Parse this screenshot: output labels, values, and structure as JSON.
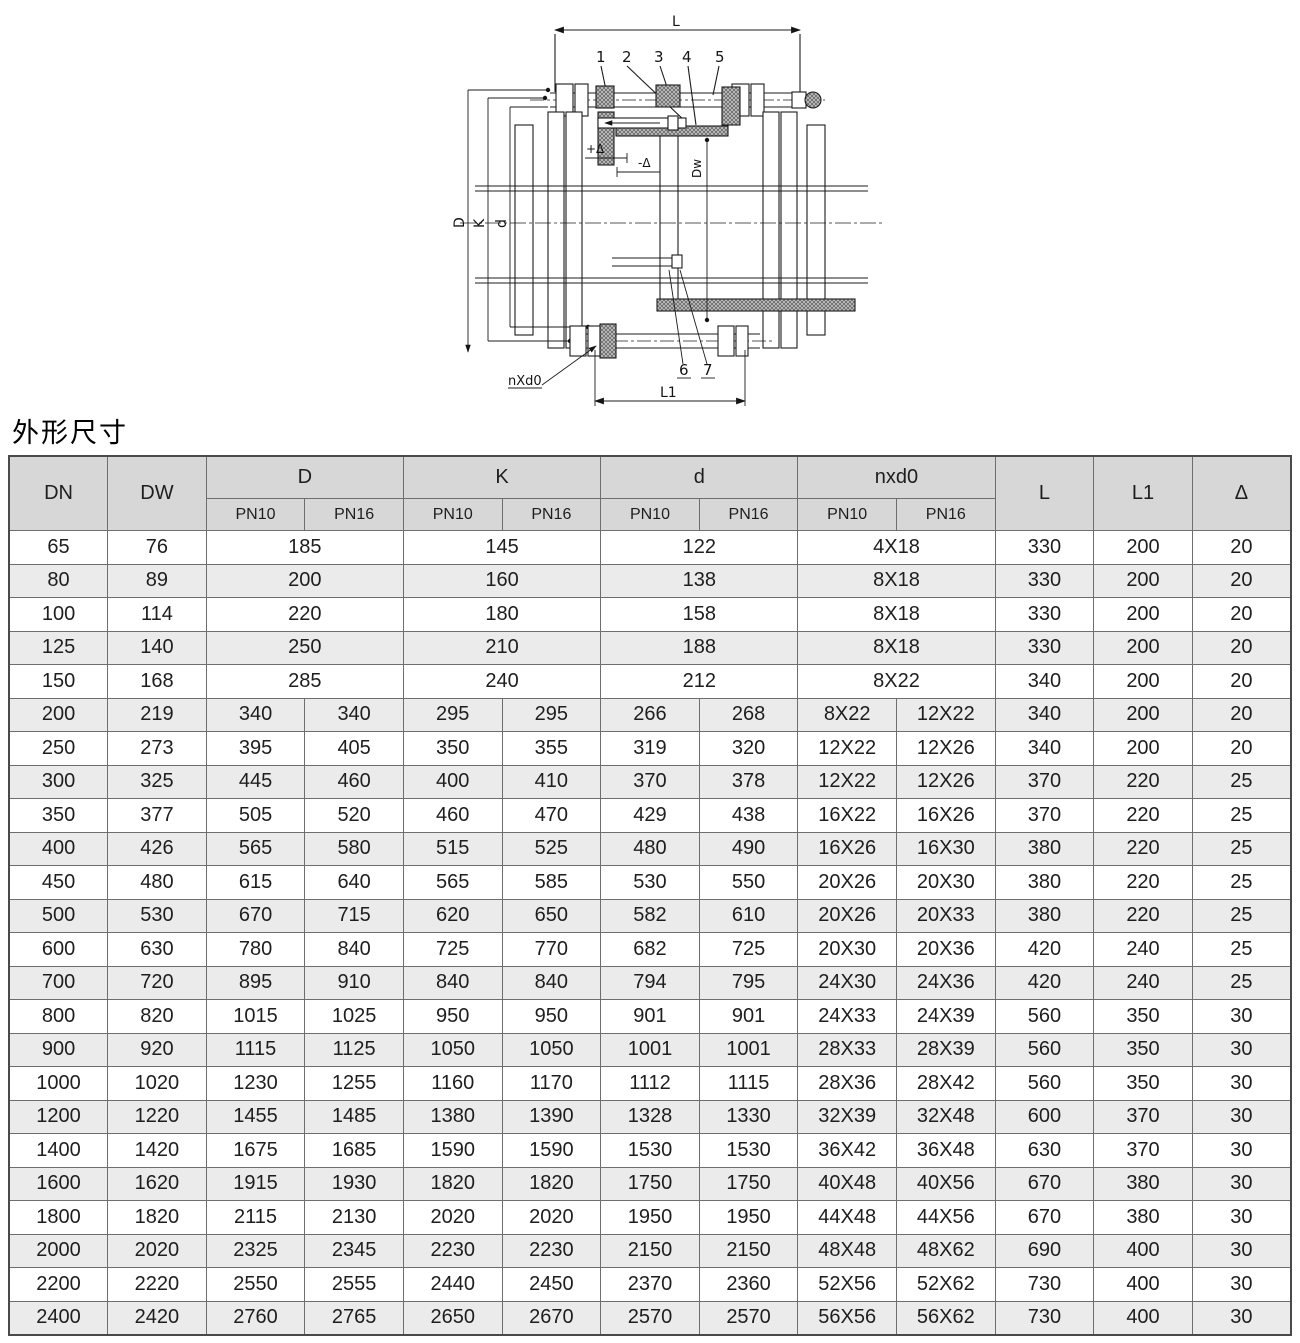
{
  "page": {
    "title": "外形尺寸"
  },
  "colors": {
    "header_bg": "#d7d7d7",
    "row_bg": "#ffffff",
    "row_alt_bg": "#ebebeb",
    "border": "#6e6e6e",
    "border_outer": "#4a4a4a",
    "text": "#1e1e1e",
    "line": "#1c1c1c"
  },
  "drawing": {
    "dim_labels": {
      "l": "L",
      "l1": "L1",
      "d_outer": "D",
      "k": "K",
      "d_inner": "d",
      "dw": "Dw",
      "nxd0": "nXd0",
      "delta_plus": "+Δ",
      "delta_minus": "-Δ"
    },
    "part_labels": [
      "1",
      "2",
      "3",
      "4",
      "5",
      "6",
      "7"
    ]
  },
  "table": {
    "headers": {
      "dn": "DN",
      "dw": "DW",
      "d_group": "D",
      "k_group": "K",
      "d_small_group": "d",
      "nxd0_group": "nxd0",
      "l": "L",
      "l1": "L1",
      "delta": "Δ",
      "pn10": "PN10",
      "pn16": "PN16"
    },
    "rows": [
      {
        "merged": true,
        "cells": [
          "65",
          "76",
          "185",
          "145",
          "122",
          "4X18",
          "330",
          "200",
          "20"
        ]
      },
      {
        "merged": true,
        "cells": [
          "80",
          "89",
          "200",
          "160",
          "138",
          "8X18",
          "330",
          "200",
          "20"
        ]
      },
      {
        "merged": true,
        "cells": [
          "100",
          "114",
          "220",
          "180",
          "158",
          "8X18",
          "330",
          "200",
          "20"
        ]
      },
      {
        "merged": true,
        "cells": [
          "125",
          "140",
          "250",
          "210",
          "188",
          "8X18",
          "330",
          "200",
          "20"
        ]
      },
      {
        "merged": true,
        "cells": [
          "150",
          "168",
          "285",
          "240",
          "212",
          "8X22",
          "340",
          "200",
          "20"
        ]
      },
      {
        "merged": false,
        "cells": [
          "200",
          "219",
          "340",
          "340",
          "295",
          "295",
          "266",
          "268",
          "8X22",
          "12X22",
          "340",
          "200",
          "20"
        ]
      },
      {
        "merged": false,
        "cells": [
          "250",
          "273",
          "395",
          "405",
          "350",
          "355",
          "319",
          "320",
          "12X22",
          "12X26",
          "340",
          "200",
          "20"
        ]
      },
      {
        "merged": false,
        "cells": [
          "300",
          "325",
          "445",
          "460",
          "400",
          "410",
          "370",
          "378",
          "12X22",
          "12X26",
          "370",
          "220",
          "25"
        ]
      },
      {
        "merged": false,
        "cells": [
          "350",
          "377",
          "505",
          "520",
          "460",
          "470",
          "429",
          "438",
          "16X22",
          "16X26",
          "370",
          "220",
          "25"
        ]
      },
      {
        "merged": false,
        "cells": [
          "400",
          "426",
          "565",
          "580",
          "515",
          "525",
          "480",
          "490",
          "16X26",
          "16X30",
          "380",
          "220",
          "25"
        ]
      },
      {
        "merged": false,
        "cells": [
          "450",
          "480",
          "615",
          "640",
          "565",
          "585",
          "530",
          "550",
          "20X26",
          "20X30",
          "380",
          "220",
          "25"
        ]
      },
      {
        "merged": false,
        "cells": [
          "500",
          "530",
          "670",
          "715",
          "620",
          "650",
          "582",
          "610",
          "20X26",
          "20X33",
          "380",
          "220",
          "25"
        ]
      },
      {
        "merged": false,
        "cells": [
          "600",
          "630",
          "780",
          "840",
          "725",
          "770",
          "682",
          "725",
          "20X30",
          "20X36",
          "420",
          "240",
          "25"
        ]
      },
      {
        "merged": false,
        "cells": [
          "700",
          "720",
          "895",
          "910",
          "840",
          "840",
          "794",
          "795",
          "24X30",
          "24X36",
          "420",
          "240",
          "25"
        ]
      },
      {
        "merged": false,
        "cells": [
          "800",
          "820",
          "1015",
          "1025",
          "950",
          "950",
          "901",
          "901",
          "24X33",
          "24X39",
          "560",
          "350",
          "30"
        ]
      },
      {
        "merged": false,
        "cells": [
          "900",
          "920",
          "1115",
          "1125",
          "1050",
          "1050",
          "1001",
          "1001",
          "28X33",
          "28X39",
          "560",
          "350",
          "30"
        ]
      },
      {
        "merged": false,
        "cells": [
          "1000",
          "1020",
          "1230",
          "1255",
          "1160",
          "1170",
          "1112",
          "1115",
          "28X36",
          "28X42",
          "560",
          "350",
          "30"
        ]
      },
      {
        "merged": false,
        "cells": [
          "1200",
          "1220",
          "1455",
          "1485",
          "1380",
          "1390",
          "1328",
          "1330",
          "32X39",
          "32X48",
          "600",
          "370",
          "30"
        ]
      },
      {
        "merged": false,
        "cells": [
          "1400",
          "1420",
          "1675",
          "1685",
          "1590",
          "1590",
          "1530",
          "1530",
          "36X42",
          "36X48",
          "630",
          "370",
          "30"
        ]
      },
      {
        "merged": false,
        "cells": [
          "1600",
          "1620",
          "1915",
          "1930",
          "1820",
          "1820",
          "1750",
          "1750",
          "40X48",
          "40X56",
          "670",
          "380",
          "30"
        ]
      },
      {
        "merged": false,
        "cells": [
          "1800",
          "1820",
          "2115",
          "2130",
          "2020",
          "2020",
          "1950",
          "1950",
          "44X48",
          "44X56",
          "670",
          "380",
          "30"
        ]
      },
      {
        "merged": false,
        "cells": [
          "2000",
          "2020",
          "2325",
          "2345",
          "2230",
          "2230",
          "2150",
          "2150",
          "48X48",
          "48X62",
          "690",
          "400",
          "30"
        ]
      },
      {
        "merged": false,
        "cells": [
          "2200",
          "2220",
          "2550",
          "2555",
          "2440",
          "2450",
          "2370",
          "2360",
          "52X56",
          "52X62",
          "730",
          "400",
          "30"
        ]
      },
      {
        "merged": false,
        "cells": [
          "2400",
          "2420",
          "2760",
          "2765",
          "2650",
          "2670",
          "2570",
          "2570",
          "56X56",
          "56X62",
          "730",
          "400",
          "30"
        ]
      }
    ]
  }
}
